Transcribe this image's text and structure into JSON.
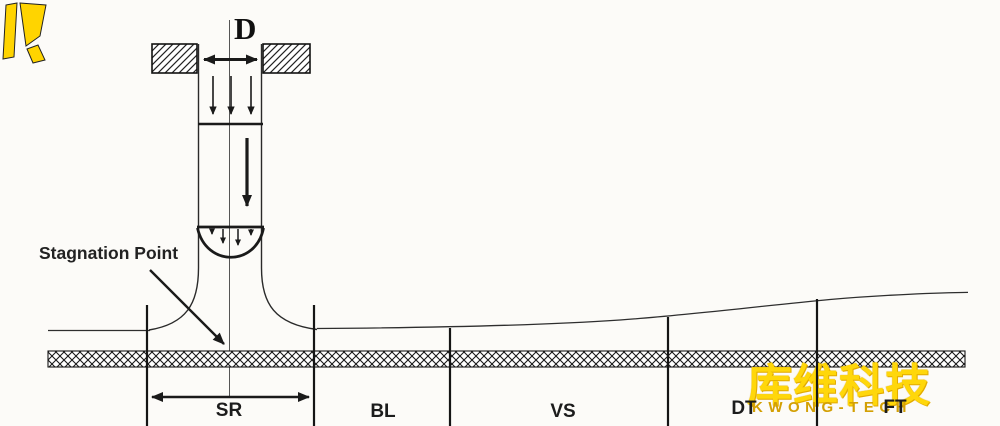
{
  "diagram": {
    "nozzle": {
      "diameter_label": "D"
    },
    "annotations": {
      "stagnation_point_label": "Stagnation Point"
    },
    "regions": [
      {
        "label": "SR"
      },
      {
        "label": "BL"
      },
      {
        "label": "VS"
      },
      {
        "label": "DT"
      },
      {
        "label": "FT"
      }
    ]
  },
  "watermark": {
    "brand_cn": "库维科技",
    "brand_en": "KWONG-TECH",
    "logo_icon": "kwong-tech-k-mark",
    "accent_yellow": "#ffd70a",
    "accent_gold": "#d3a004"
  },
  "colors": {
    "background": "#fcfbf8",
    "line": "#1a1a1a"
  }
}
